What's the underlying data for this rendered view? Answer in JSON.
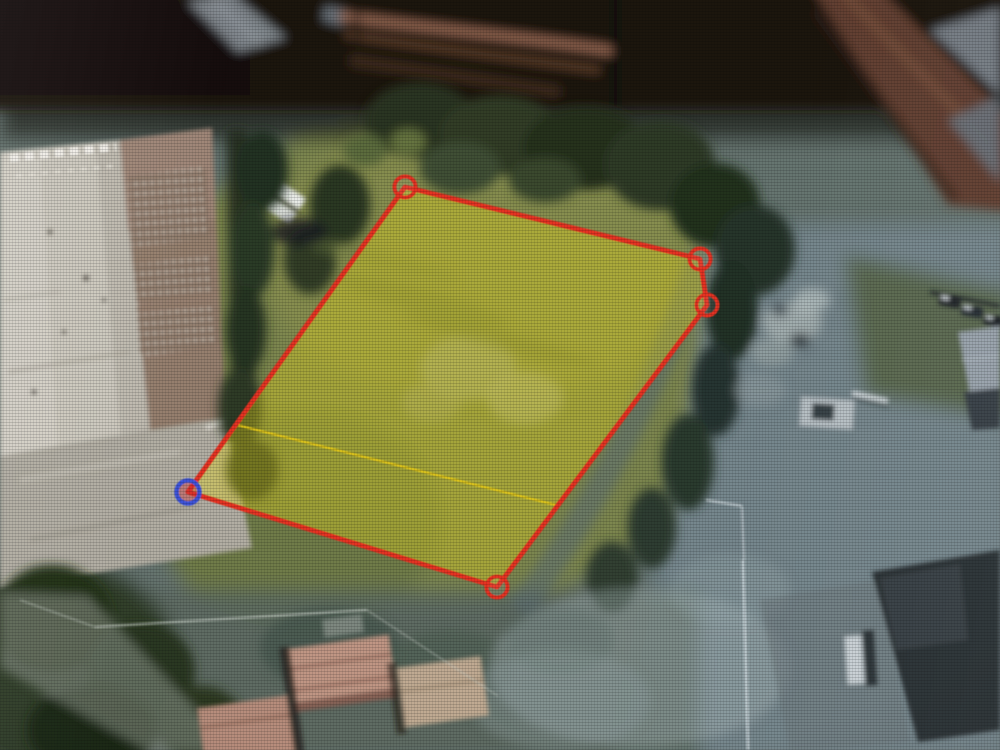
{
  "map_view": {
    "kind": "satellite-aerial-photo",
    "description": "Photograph of a screen showing aerial imagery of an industrial and residential area with a surveyed land parcel highlighted"
  },
  "parcel": {
    "fill_color": "#e8d820",
    "fill_opacity": 0.38,
    "stroke_color": "#e63120",
    "stroke_width": 5,
    "vertices": [
      {
        "x": 405,
        "y": 187,
        "selected": false
      },
      {
        "x": 700,
        "y": 259,
        "selected": false
      },
      {
        "x": 707,
        "y": 305,
        "selected": false
      },
      {
        "x": 497,
        "y": 587,
        "selected": false
      },
      {
        "x": 188,
        "y": 492,
        "selected": true
      }
    ],
    "marker": {
      "radius": 10.5,
      "stroke_width": 4,
      "color": "#e63120",
      "selected_color": "#3c52d9",
      "selected_radius": 11.5,
      "selected_stroke_width": 4.5,
      "selected_fill": "rgba(205,50,55,0.40)"
    },
    "measure_line": {
      "color": "#e3c714",
      "width": 2.3,
      "opacity": 0.92,
      "from": {
        "x": 237,
        "y": 425
      },
      "to": {
        "x": 556,
        "y": 505
      }
    }
  }
}
